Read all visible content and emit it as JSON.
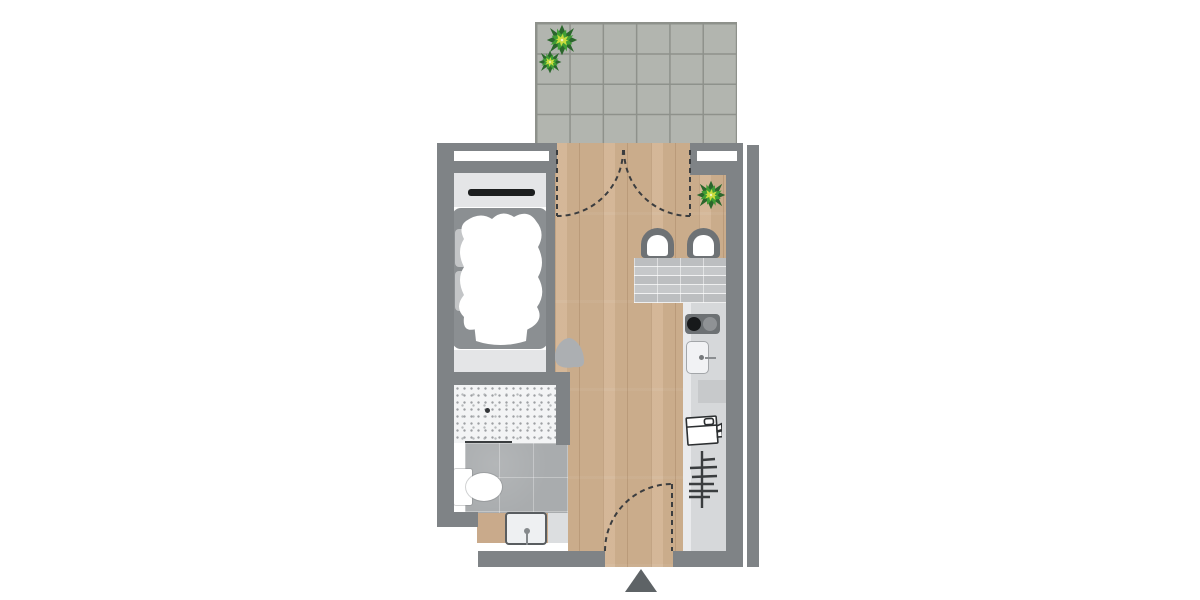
{
  "meta": {
    "type": "architectural-floor-plan",
    "description": "Top-down floor plan of a studio apartment with terrace, sleeping niche, bathroom, kitchen strip and entrance",
    "canvas": {
      "width_px": 1200,
      "height_px": 600,
      "background": "#ffffff"
    }
  },
  "colors": {
    "wall": "#7f8386",
    "terrace_tile": "#b2b5af",
    "terrace_grout": "#8e918b",
    "wood": "#d2b392",
    "cabinet": "#e4e5e7",
    "rail": "#1c1e1f",
    "bed_frame": "#8b8f92",
    "shower_base": "#f3f4f5",
    "shower_speckle": "#9da0a3",
    "bath_tile": "#a9acae",
    "counter_tan": "#c9aa8b",
    "kitchen_counter": "#d6d8da",
    "bar_top": "#c6c8ca",
    "chair": "#6e7275",
    "stove": "#6d7174",
    "glass": "#3a3d3f",
    "door_dash": "#3b3d3f",
    "entrance_marker": "#5e6366",
    "plant_dark": "#2b672c",
    "plant_mid": "#3f9e35",
    "plant_light": "#c9dc3e"
  },
  "rooms": [
    {
      "name": "terrace",
      "position": "top",
      "flooring": "concrete tiles 6x4 grid",
      "features": [
        "potted plant large",
        "potted plant small"
      ]
    },
    {
      "name": "sleeping-area",
      "position": "left",
      "furniture": [
        "wardrobe with hanging rail",
        "double bed with white duvet and pillows",
        "foot bench",
        "beanbag"
      ]
    },
    {
      "name": "bathroom",
      "position": "bottom-left",
      "flooring": "grey ceramic tiles",
      "furniture": [
        "mosaic walk-in shower with drain",
        "glass partition",
        "toilet",
        "washbasin on wooden counter"
      ]
    },
    {
      "name": "living-room",
      "position": "center",
      "flooring": "oak plank parquet",
      "furniture": [
        "breakfast bar with stone top",
        "chair left",
        "chair right",
        "potted plant"
      ]
    },
    {
      "name": "kitchen-strip",
      "position": "right",
      "furniture": [
        "two-burner cooktop",
        "sink with faucet",
        "refrigerator",
        "shelf rack"
      ]
    },
    {
      "name": "entrance",
      "position": "bottom-center",
      "features": [
        "single swing door",
        "entrance marker triangle"
      ]
    }
  ],
  "doors": [
    {
      "name": "terrace-french-door",
      "type": "double swing",
      "location": "top wall",
      "swing": "inward, two dashed quarter arcs"
    },
    {
      "name": "entry-door",
      "type": "single swing",
      "location": "bottom wall",
      "swing": "inward, dashed quarter arc"
    }
  ],
  "icons": [
    {
      "name": "plant-icon",
      "meaning": "potted plant seen from above",
      "count": 3
    },
    {
      "name": "fridge-icon",
      "meaning": "refrigerator with open door symbol"
    },
    {
      "name": "shelf-rack-icon",
      "meaning": "shelving / drying rack symbol"
    },
    {
      "name": "entrance-marker-icon",
      "meaning": "triangle marking apartment entrance"
    }
  ]
}
